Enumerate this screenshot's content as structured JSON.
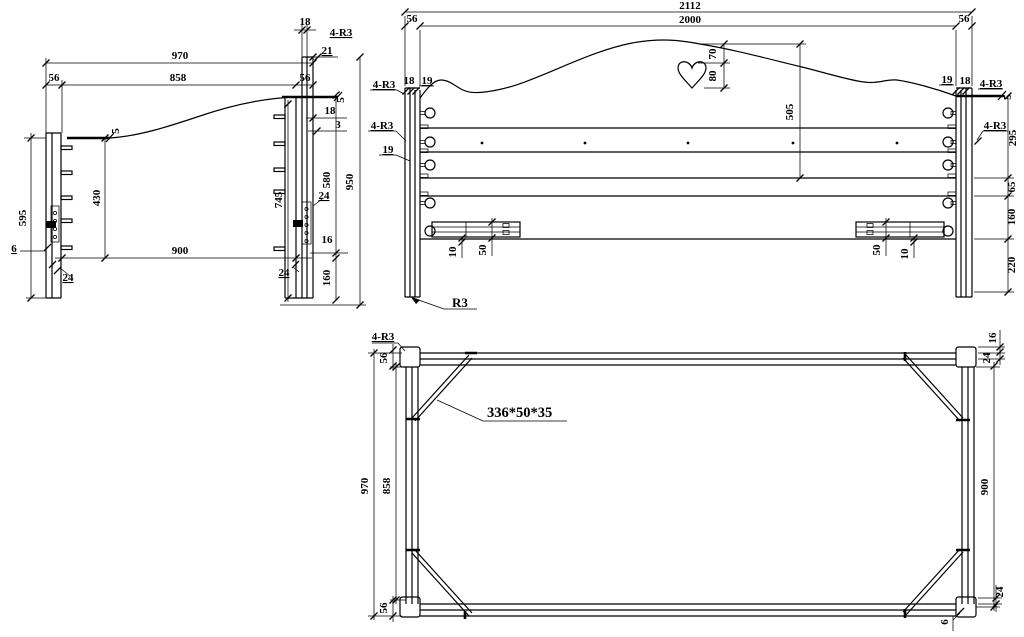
{
  "colors": {
    "background": "#ffffff",
    "line": "#000000"
  },
  "side_view": {
    "dim_970": "970",
    "dim_858": "858",
    "dim_56_left": "56",
    "dim_56_right": "56",
    "dim_18_top": "18",
    "label_4r3_top": "4-R3",
    "dim_21": "21",
    "flag_5_left": "5",
    "flag_5_right": "5",
    "dim_18_right": "18",
    "dim_3": "3",
    "dim_595": "595",
    "dim_430": "430",
    "dim_900": "900",
    "dim_745": "745",
    "dim_580": "580",
    "dim_950": "950",
    "dim_6": "6",
    "dim_24_left": "24",
    "dim_24_right": "24",
    "dim_16": "16",
    "dim_160": "160",
    "dim_24_bottom": "24"
  },
  "front_view": {
    "dim_2112": "2112",
    "dim_2000": "2000",
    "dim_56_left": "56",
    "dim_56_right": "56",
    "label_4r3_top_left": "4-R3",
    "dim_18_left": "18",
    "dim_19_left_top": "19",
    "label_4r3_mid_left": "4-R3",
    "dim_19_left": "19",
    "dim_19_right_top": "19",
    "dim_18_right": "18",
    "label_4r3_top_right": "4-R3",
    "flag_5_right": "5",
    "label_4r3_mid_right": "4-R3",
    "dim_70": "70",
    "dim_80": "80",
    "dim_505": "505",
    "dim_295": "295",
    "dim_65": "65",
    "dim_160": "160",
    "dim_220": "220",
    "dim_10_left": "10",
    "dim_50_left": "50",
    "dim_50_right": "50",
    "dim_10_right": "10",
    "label_r3": "R3"
  },
  "plan_view": {
    "label_4r3": "4-R3",
    "dim_56_top": "56",
    "dim_56_bottom": "56",
    "dim_970": "970",
    "dim_858": "858",
    "dim_900": "900",
    "dim_16": "16",
    "dim_24_top": "24",
    "dim_24_bottom": "24",
    "dim_6": "6",
    "label_brace": "336*50*35"
  }
}
